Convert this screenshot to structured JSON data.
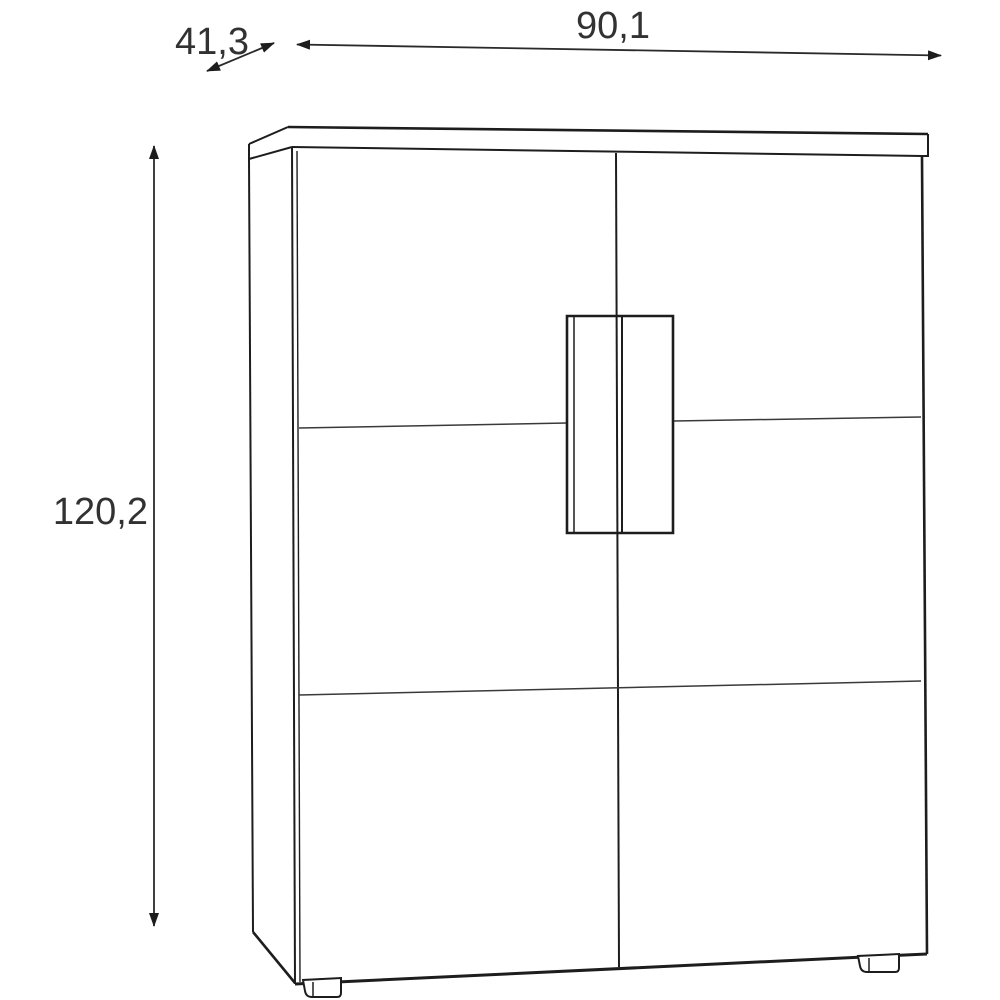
{
  "diagram": {
    "type": "furniture-dimension-drawing",
    "subject": "two-door-cabinet",
    "background_color": "#ffffff",
    "line_color": "#1d1d1d",
    "dimension_text_color": "#323232",
    "dimensions": {
      "width": {
        "value": "90,1",
        "orientation": "horizontal"
      },
      "depth": {
        "value": "41,3",
        "orientation": "diagonal"
      },
      "height": {
        "value": "120,2",
        "orientation": "vertical"
      }
    }
  }
}
